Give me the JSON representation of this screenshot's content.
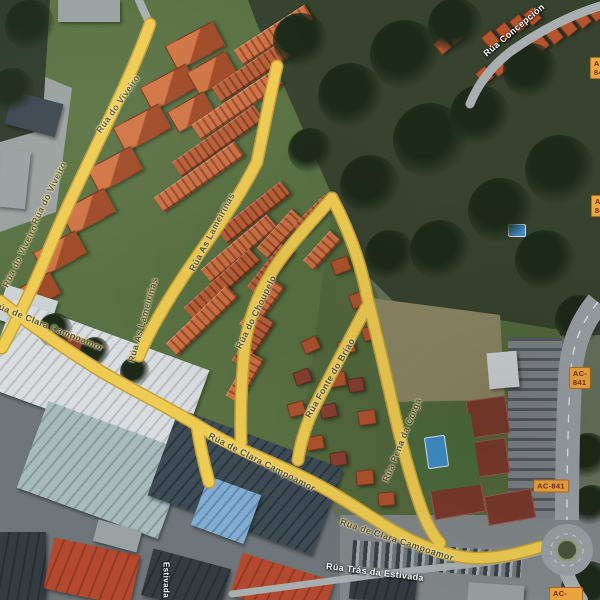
{
  "map": {
    "view": "satellite",
    "street_labels": [
      {
        "text": "Rúa do Viveiro"
      },
      {
        "text": "Rúa do Viveiro"
      },
      {
        "text": "Rúa do Viveiro"
      },
      {
        "text": "Rúa de Clara Campoamor"
      },
      {
        "text": "Rúa de Clara Campoamor"
      },
      {
        "text": "Rúa de Clara Campoamor"
      },
      {
        "text": "Rúa As Lameiriñas"
      },
      {
        "text": "Rúa As Lameiriñas"
      },
      {
        "text": "Rúa do Choupelo"
      },
      {
        "text": "Rúa Fonte do Briao"
      },
      {
        "text": "Rúa Pena da Corga"
      },
      {
        "text": "Rúa Trás da Estivada"
      },
      {
        "text": "Rúa Concepción"
      },
      {
        "text": "Estivada"
      }
    ],
    "route_badge": "AC-841",
    "palette": {
      "road_yellow": "#eecb52",
      "road_label_text": "#5a5133",
      "white_label_text": "#ffffff",
      "badge_background": "#f0a73d",
      "badge_text": "#78290f",
      "roof_orange": "#c2653c",
      "roof_red": "#b5492f",
      "grass_green": "#5a7243",
      "woods_green": "#37432e",
      "pool_blue": "#3f8fc9"
    }
  }
}
